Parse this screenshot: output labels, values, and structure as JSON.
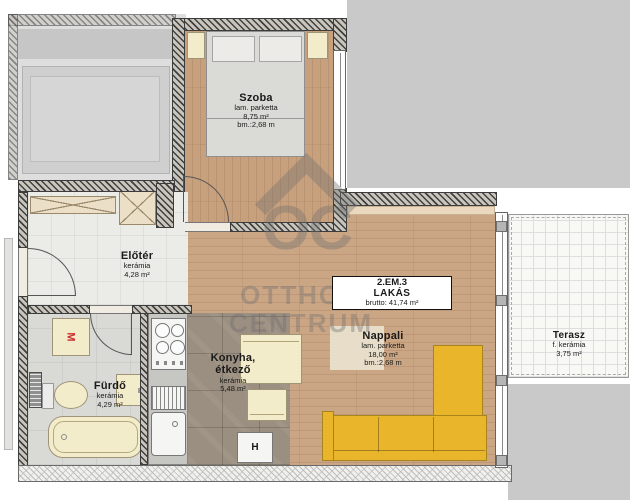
{
  "unit_box": {
    "line1": "2.EM.3",
    "line2": "LAKÁS",
    "line3": "brutto: 41,74 m²"
  },
  "rooms": {
    "szoba": {
      "name": "Szoba",
      "material": "lam. parketta",
      "area": "8,75 m²",
      "height": "bm.:2,68 m"
    },
    "eloter": {
      "name": "Előtér",
      "material": "kerámia",
      "area": "4,28 m²"
    },
    "nappali": {
      "name": "Nappali",
      "material": "lam. parketta",
      "area": "18,00 m²",
      "height": "bm.:2,68 m"
    },
    "konyha": {
      "name1": "Konyha,",
      "name2": "étkező",
      "material": "kerámia",
      "area": "5,48 m²"
    },
    "furdo": {
      "name": "Fürdő",
      "material": "kerámia",
      "area": "4,29 m²"
    },
    "terasz": {
      "name": "Terasz",
      "material": "f. kerámia",
      "area": "3,75 m²"
    }
  },
  "appliances": {
    "washing_machine": "M",
    "fridge": "H"
  },
  "watermark": {
    "logo": "OC",
    "line1": "OTTHON",
    "line2": "CENTRUM"
  },
  "colors": {
    "wood_floor": "#cba685",
    "kitchen_tile": "#9b8f81",
    "sofa_yellow": "#e9b52b",
    "fixture_cream": "#f3ecca",
    "outside_gray": "#c9c9c9",
    "washer_letter_red": "#cc2a2a"
  }
}
